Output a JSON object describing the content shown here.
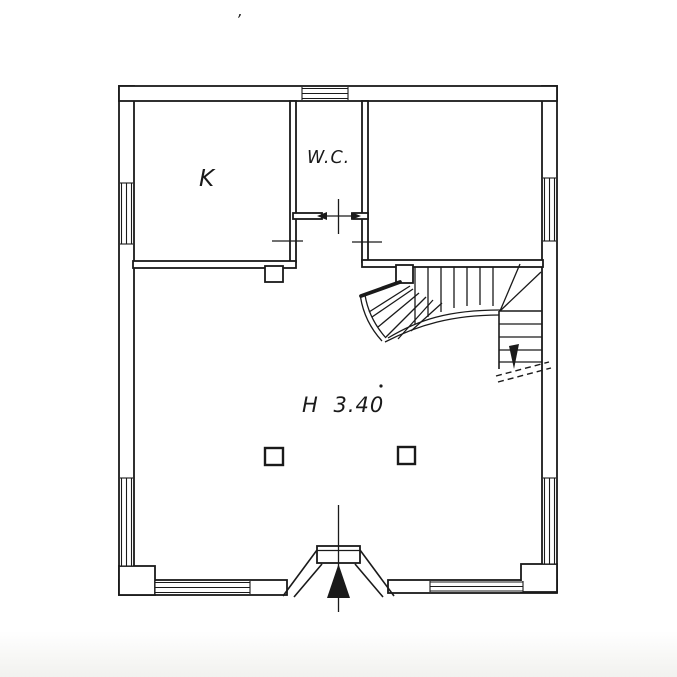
{
  "colors": {
    "ink": "#1a1a1a",
    "paper": "#ffffff"
  },
  "labels": {
    "kitchen": "K",
    "wc": "W.C.",
    "ceiling_height": "H 3.40",
    "stray_mark": "’"
  }
}
